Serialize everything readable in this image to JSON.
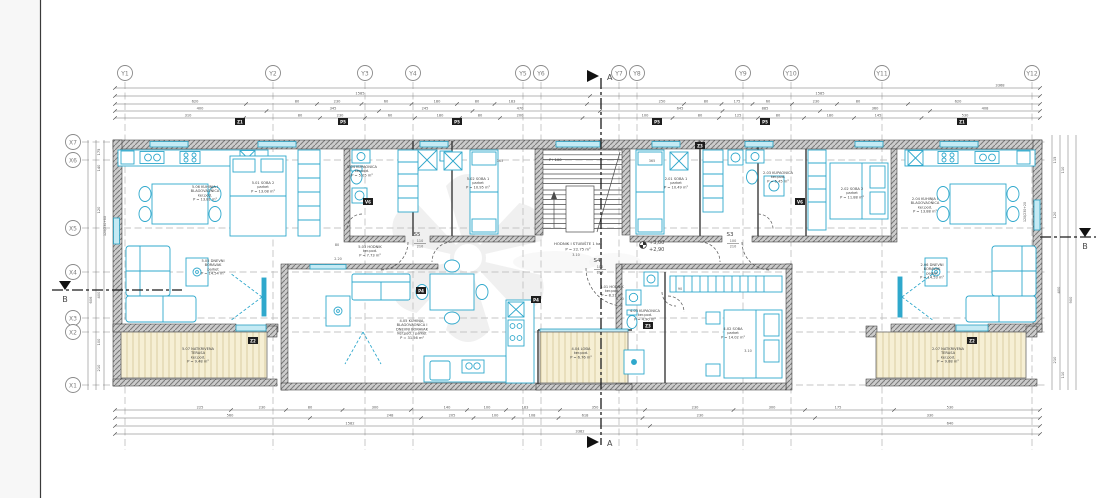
{
  "grid": {
    "y_labels": [
      "Y1",
      "Y2",
      "Y3",
      "Y4",
      "Y5",
      "Y6",
      "Y7",
      "Y8",
      "Y9",
      "Y10",
      "Y11",
      "Y12"
    ],
    "x_labels": [
      "X7",
      "X6",
      "X5",
      "X4",
      "X3",
      "X2",
      "X1"
    ]
  },
  "sections": {
    "a": "A",
    "b": "B"
  },
  "stairs": {
    "level_tag": "P+100",
    "hall_label": "HODNIK I STUBIŠTE 1 kat",
    "hall_area": "P = 22.75 m²",
    "elev_top": "+3,00",
    "elev_bottom": "+2,90"
  },
  "doors": [
    {
      "tag": "S5",
      "w": "110",
      "h": "210"
    },
    {
      "tag": "S3",
      "w": "100",
      "h": "210"
    },
    {
      "tag": "S4",
      "w": "100",
      "h": "210"
    }
  ],
  "wall_openings": {
    "left_window": "120/230+80",
    "right_window": "120/230+20"
  },
  "rooms": [
    {
      "lines": [
        "5.06 KUHINJA I",
        "BLAGOVAONICA",
        "ker.pod.",
        "P = 13.81 m²"
      ]
    },
    {
      "lines": [
        "5.01 SOBA 2",
        "parket",
        "P = 13.08 m²"
      ]
    },
    {
      "lines": [
        "5.04 KUPAONICA",
        "ker.pod.",
        "P = 5.05 m²"
      ]
    },
    {
      "lines": [
        "5.02 SOBA 1",
        "parket",
        "P = 10.95 m²"
      ]
    },
    {
      "lines": [
        "5.03 HODNIK",
        "ker.pod.",
        "P = 7.73 m²"
      ]
    },
    {
      "lines": [
        "5.05 DNEVNI",
        "BORAVAK",
        "parket",
        "P = 14.54 m²"
      ]
    },
    {
      "lines": [
        "5.07 NATKRIVENA",
        "TERASA",
        "ker.pod.",
        "P = 9.48 m²"
      ]
    },
    {
      "lines": [
        "4.05 KUHINJA,",
        "BLAGOVAONICA I",
        "DNEVNI BORAVAK",
        "ker.pod. i parket",
        "P = 31.56 m²"
      ]
    },
    {
      "lines": [
        "4.01 HODNIK",
        "ker.pod.",
        "P = 8.21 m²"
      ]
    },
    {
      "lines": [
        "4.03 KUPAONICA",
        "ker.pod.",
        "P = 4.90 m²"
      ]
    },
    {
      "lines": [
        "4.02 SOBA",
        "parket",
        "P = 14.02 m²"
      ]
    },
    {
      "lines": [
        "4.04 LOĐA",
        "ker.pod.",
        "P = 6.76 m²"
      ]
    },
    {
      "lines": [
        "2.01 SOBA 1",
        "parket",
        "P = 10.49 m²"
      ]
    },
    {
      "lines": [
        "2.03 KUPAONICA",
        "ker.pod.",
        "P = 5.45 m²"
      ]
    },
    {
      "lines": [
        "2.02 SOBA 2",
        "parket",
        "P = 11.88 m²"
      ]
    },
    {
      "lines": [
        "2.04 KUHINJA I",
        "BLAGOVAONICA",
        "ker.pod.",
        "P = 13.88 m²"
      ]
    },
    {
      "lines": [
        "2.06 DNEVNI",
        "BORAVAK",
        "parket",
        "P = 14.53 m²"
      ]
    },
    {
      "lines": [
        "2.07 NATKRIVENA",
        "TERASA",
        "ker.pod.",
        "P = 9.88 m²"
      ]
    }
  ],
  "window_tags": [
    "Z1",
    "P5",
    "P5",
    "P5",
    "P5",
    "Z1",
    "V6",
    "V6",
    "Z2",
    "Z2",
    "P4",
    "P4",
    "Z3",
    "Z3"
  ],
  "dimensions": {
    "top": [
      [
        "3368"
      ],
      [
        "1585",
        "1585"
      ],
      [
        "620",
        "80",
        "230",
        "60",
        "180",
        "80",
        "183",
        "250",
        "80",
        "175",
        "60",
        "230",
        "80",
        "620"
      ],
      [
        "400",
        "345",
        "245",
        "470",
        "645",
        "885",
        "360",
        "408"
      ],
      [
        "310",
        "80",
        "230",
        "60",
        "180",
        "80",
        "200",
        "100",
        "80",
        "125",
        "80",
        "180",
        "145",
        "530"
      ]
    ],
    "bottom": [
      [
        "225",
        "230",
        "80",
        "300",
        "140",
        "100",
        "183",
        "350",
        "230",
        "300",
        "175",
        "530"
      ],
      [
        "560",
        "248",
        "205",
        "100",
        "108",
        "618",
        "230",
        "330"
      ],
      [
        "1582",
        "640"
      ],
      [
        "3382"
      ]
    ],
    "left": [
      "175",
      "140",
      "120",
      "400",
      "100",
      "210",
      "606"
    ],
    "right": [
      "115",
      "110",
      "120",
      "400",
      "210",
      "110",
      "900"
    ],
    "interior": [
      "365",
      "365",
      "3.10",
      "2.20",
      "90",
      "1.20",
      "3.10",
      "80"
    ]
  }
}
